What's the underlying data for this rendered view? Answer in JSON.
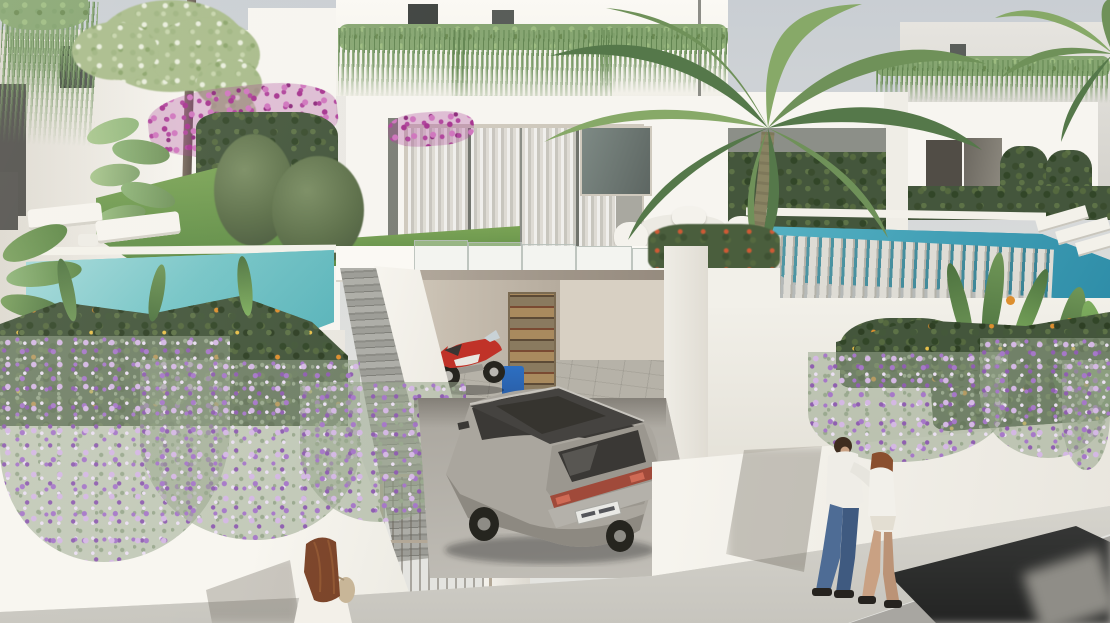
{
  "scene": {
    "type": "architectural-3d-render",
    "setting": "modern white villa development with private pools, street level garage and sidewalk",
    "inventory": {
      "people": 3,
      "pools": 2,
      "vehicles": [
        "silver suv",
        "red motorcycle",
        "blurred passing car"
      ]
    }
  },
  "palette": {
    "sky_top": "#c9ced3",
    "sky_bottom": "#e4e4e0",
    "wall_bright": "#f7f5f0",
    "wall_mid": "#efede6",
    "wall_shadow": "#ddd9d0",
    "window_dark": "#3e423f",
    "glass_tint": "#7e8a85",
    "curtain_light": "#dedbd4",
    "curtain_dark": "#cfccc5",
    "frame_beige": "#cfc9bd",
    "seam_dark": "#70736c",
    "pool_left_light": "#a7dada",
    "pool_left_mid": "#74c4c6",
    "pool_left_deep": "#50aeb6",
    "pool_right_light": "#57b3c4",
    "pool_right_deep": "#2e8da8",
    "coping_white": "#f3f1ea",
    "lawn_light": "#7aa355",
    "lawn_deep": "#5c8a44",
    "hedge_dark": "#44563c",
    "hedge_green": "#86a571",
    "leaf_light": "#8fb579",
    "palm_light": "#87a968",
    "palm_mid": "#6f9159",
    "palm_deep": "#55784a",
    "palm_trunk": "#8a8463",
    "trunk_brown": "#6e6257",
    "strand_green": "#9aa98f",
    "flower_light": "#d4b8e4",
    "flower_purple": "#a678c8",
    "flower_deep": "#8f5fb0",
    "bougain_light": "#b0439c",
    "bougain_deep": "#a6338f",
    "orange_flower": "#dd8f2f",
    "flame_red": "#cf5a35",
    "step_dark": "#8b8b85",
    "pave_light": "#d6d4cd",
    "pave_dark": "#c7c5be",
    "street_gray": "#a8a6a1",
    "car_silver": "#aaa69e",
    "car_silver_dark": "#8d8981",
    "car_roof": "#454340",
    "car_glass": "#36342f",
    "tail_red": "#a04a3a",
    "plate_white": "#e9e9e5",
    "moto_red": "#c03228",
    "wheel_dark": "#26251f",
    "rim_silver": "#b9b7b1",
    "bin_blue": "#2d6fc2",
    "skin": "#c9a183",
    "hair_auburn": "#8a4f2e",
    "hair_dark": "#3f2d20",
    "jeans_blue": "#4e6c95",
    "shirt_white": "#efede7",
    "gate_frame": "#b3a897"
  }
}
